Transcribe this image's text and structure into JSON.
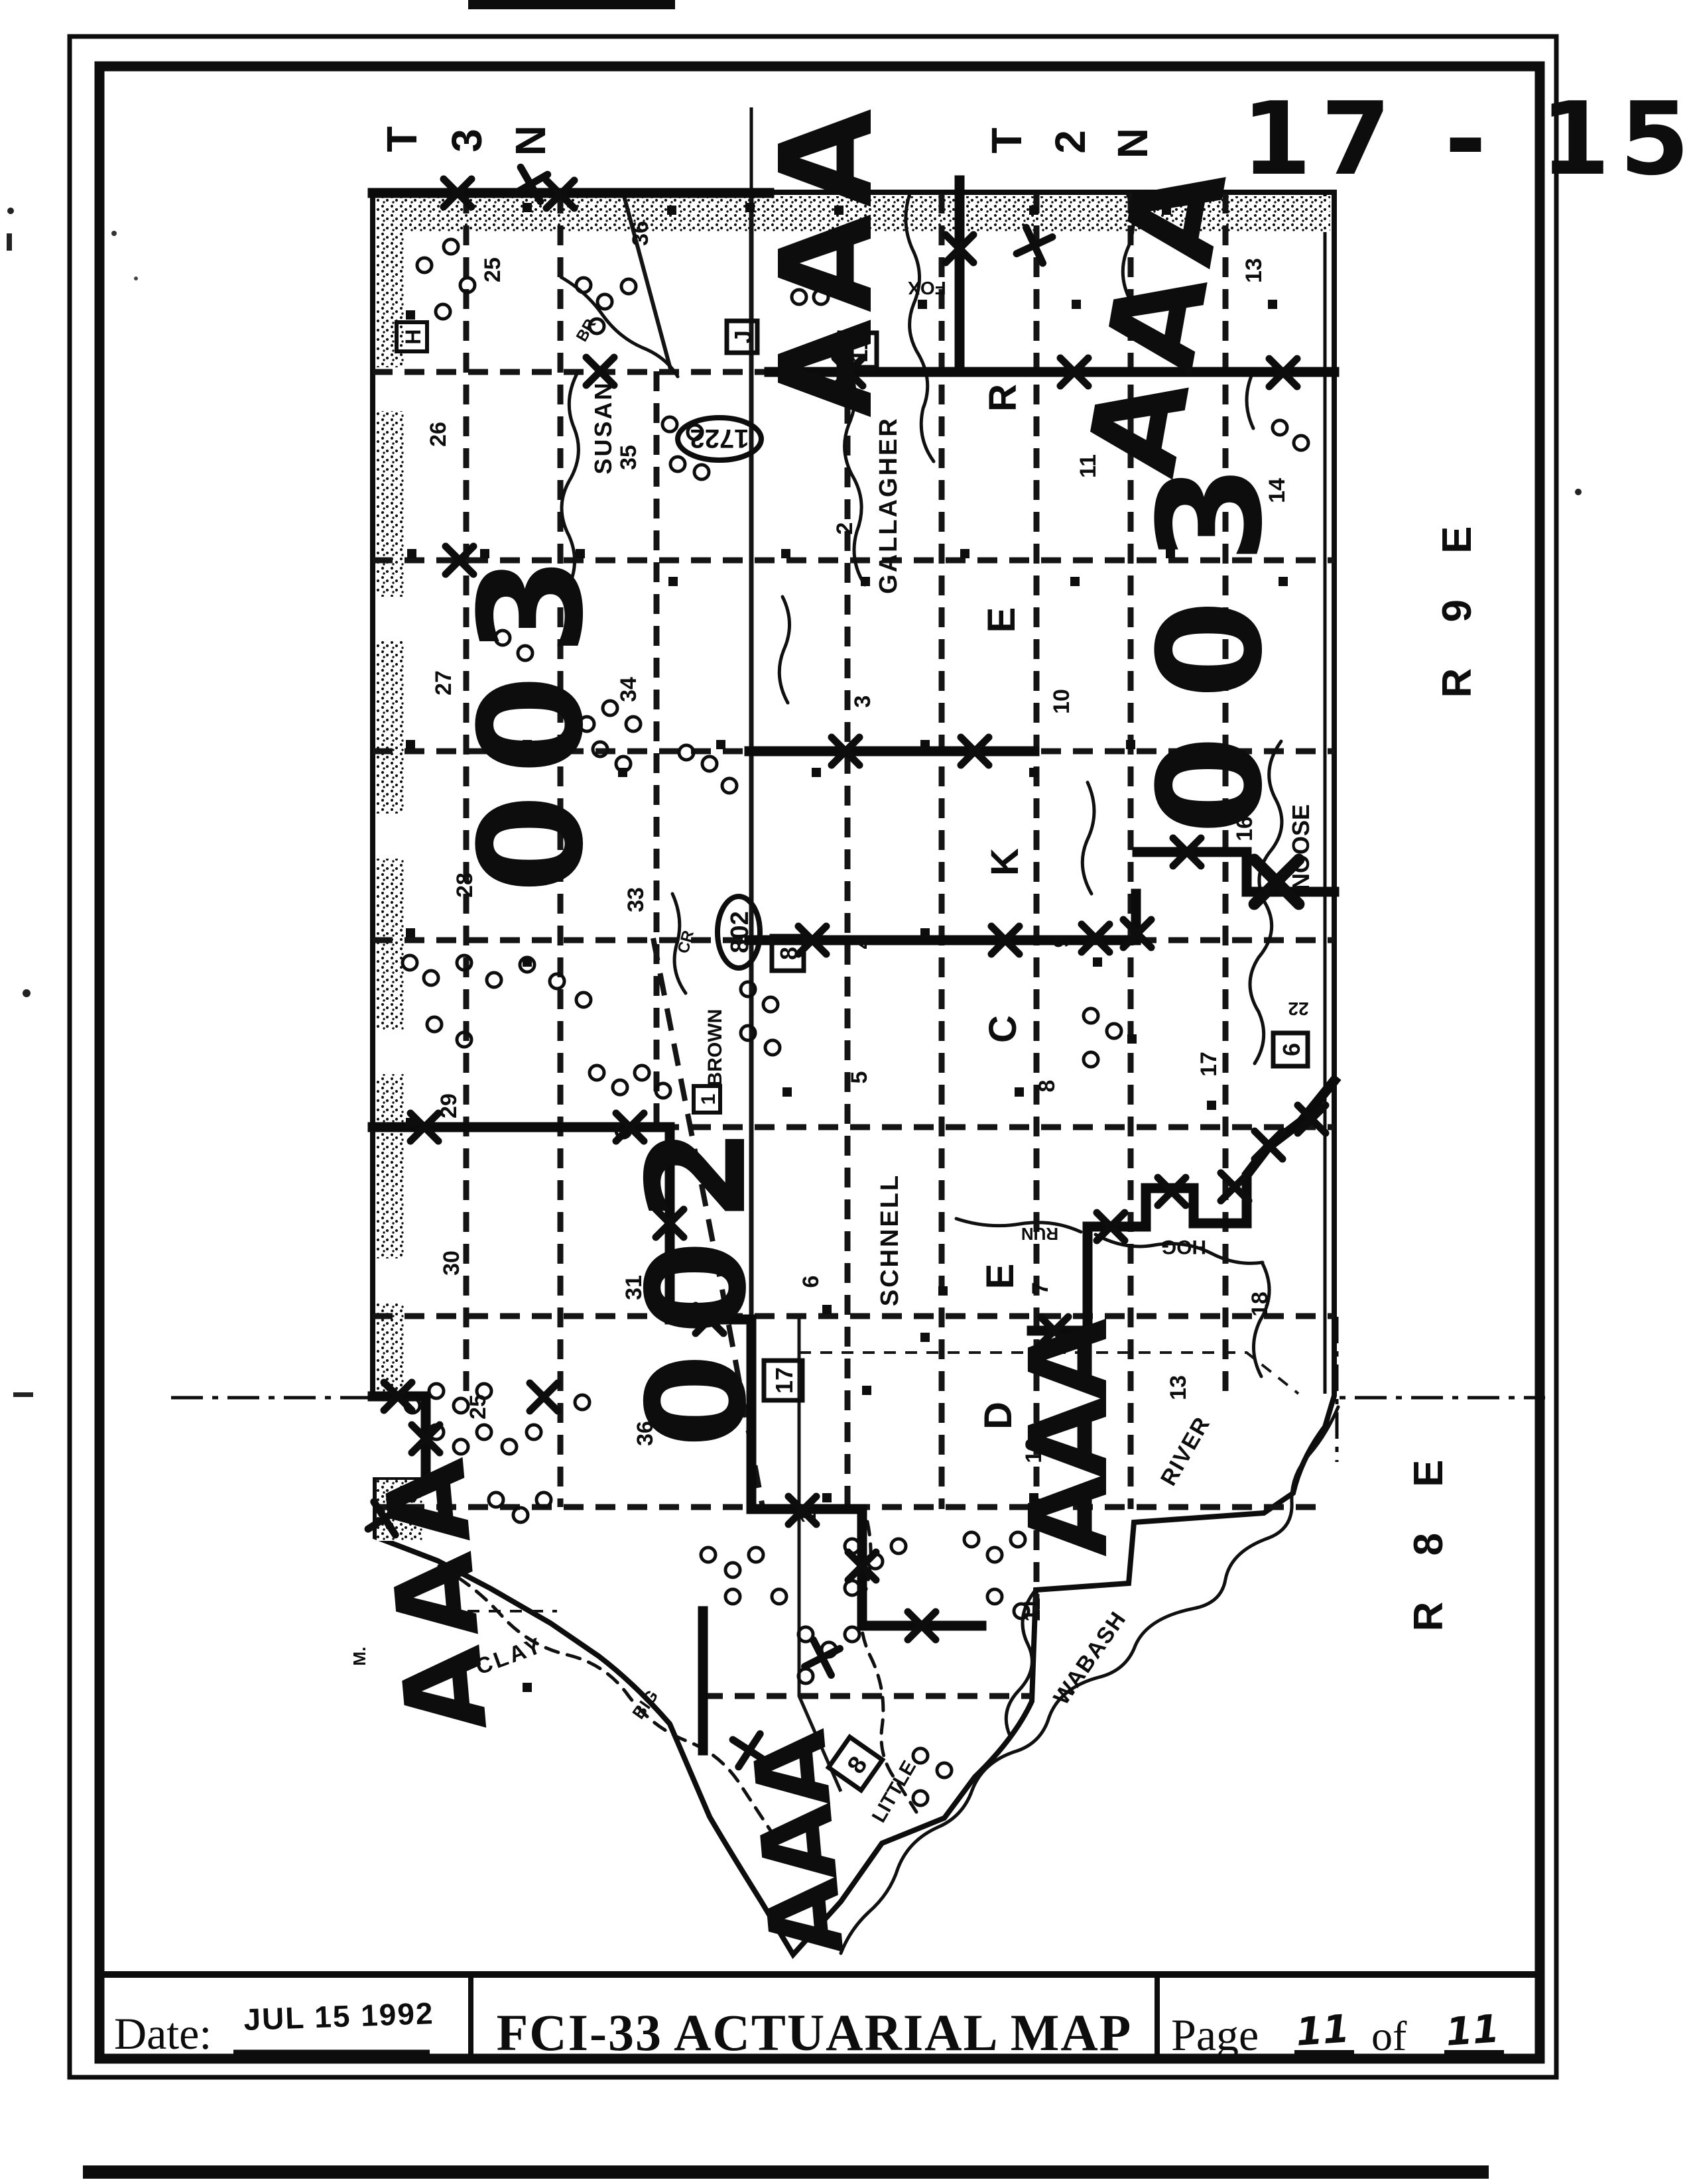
{
  "stamp": {
    "main": "17 - 15",
    "last": "9"
  },
  "titlebar": {
    "date_label": "Date:",
    "date_value": "JUL 15 1992",
    "title": "FCI-33 ACTUARIAL MAP",
    "page_label": "Page",
    "page_current": "11",
    "of_label": "of",
    "page_total": "11"
  },
  "margin": {
    "t3n": [
      "T",
      "3",
      "N"
    ],
    "t2n": [
      "T",
      "2",
      "N"
    ],
    "r9e": "R 9 E",
    "r8e": "R 8 E"
  },
  "annotations": {
    "zone003": "003",
    "zone002": "002",
    "aaa": "AAA"
  },
  "zones": [
    "R",
    "E",
    "K",
    "C",
    "E",
    "D"
  ],
  "routes": {
    "oval1722": "1722",
    "oval802": "802",
    "boxJ": "J",
    "box11": "11",
    "box8": "8",
    "box6": "6",
    "box17": "17",
    "box1": "1",
    "boxH": "H",
    "box8b": "8",
    "small22": "22"
  },
  "names": {
    "susan": "SUSAN",
    "gallagher": "GALLAGHER",
    "schnell": "SCHNELL",
    "clay": "CLAY",
    "noose": "NOOSE",
    "hog": "HOG",
    "brown": "BROWN",
    "fox": "FOX",
    "run": "RUN",
    "br": "BR",
    "cr": "CR",
    "big": "BIG",
    "little": "LITTLE",
    "wabash": "WABASH",
    "river": "RIVER",
    "m": "M."
  },
  "sections": [
    "25",
    "36",
    "26",
    "35",
    "27",
    "34",
    "28",
    "33",
    "29",
    "30",
    "31",
    "36",
    "25",
    "1",
    "2",
    "3",
    "4",
    "5",
    "6",
    "8",
    "11",
    "10",
    "9",
    "7",
    "12",
    "11",
    "13",
    "14",
    "16",
    "17",
    "18",
    "13",
    "22"
  ]
}
